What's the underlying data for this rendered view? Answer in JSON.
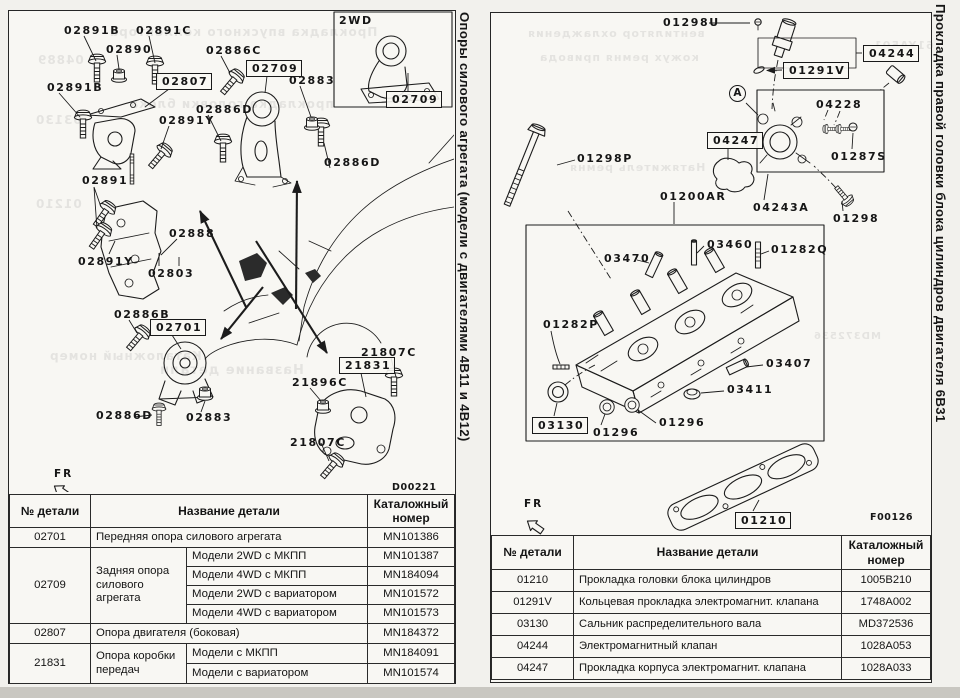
{
  "scan": {
    "paper_color": "#f8f7f3",
    "ink_color": "#1c1c1c",
    "margin_color": "#f2f1ed",
    "bottom_band_color": "#c9c7c1"
  },
  "left": {
    "title": "Опоры силового агрегата (модели с двигателями 4В11 и 4В12)",
    "labels": [
      {
        "t": "02891B",
        "x": 55,
        "y": 14
      },
      {
        "t": "02891C",
        "x": 127,
        "y": 14
      },
      {
        "t": "02890",
        "x": 97,
        "y": 33
      },
      {
        "t": "02886C",
        "x": 197,
        "y": 34
      },
      {
        "t": "02709",
        "x": 237,
        "y": 49,
        "b": 1
      },
      {
        "t": "02807",
        "x": 147,
        "y": 62,
        "b": 1
      },
      {
        "t": "02883",
        "x": 280,
        "y": 64
      },
      {
        "t": "02891B",
        "x": 38,
        "y": 71
      },
      {
        "t": "02886D",
        "x": 187,
        "y": 93
      },
      {
        "t": "02891Y",
        "x": 150,
        "y": 104
      },
      {
        "t": "02886D",
        "x": 315,
        "y": 146
      },
      {
        "t": "02891",
        "x": 73,
        "y": 164
      },
      {
        "t": "02888",
        "x": 160,
        "y": 217
      },
      {
        "t": "02891Y",
        "x": 69,
        "y": 245
      },
      {
        "t": "02803",
        "x": 139,
        "y": 257
      },
      {
        "t": "02886B",
        "x": 105,
        "y": 298
      },
      {
        "t": "02701",
        "x": 141,
        "y": 308,
        "b": 1
      },
      {
        "t": "02886D",
        "x": 87,
        "y": 399
      },
      {
        "t": "02883",
        "x": 177,
        "y": 401
      },
      {
        "t": "21807C",
        "x": 352,
        "y": 336
      },
      {
        "t": "21831",
        "x": 330,
        "y": 346,
        "b": 1
      },
      {
        "t": "21896C",
        "x": 283,
        "y": 366
      },
      {
        "t": "21807C",
        "x": 281,
        "y": 426
      },
      {
        "t": "2WD",
        "x": 330,
        "y": 4
      },
      {
        "t": "02709",
        "x": 377,
        "y": 80,
        "b": 1
      },
      {
        "t": "FR",
        "x": 45,
        "y": 458,
        "c": "fr"
      },
      {
        "t": "D00221",
        "x": 383,
        "y": 472,
        "c": "code"
      }
    ],
    "bleed": [
      {
        "t": "04889",
        "x": 28,
        "y": 42,
        "s": 12
      },
      {
        "t": "Прокладка впускного коллектора",
        "x": 100,
        "y": 14,
        "s": 12
      },
      {
        "t": "03130",
        "x": 26,
        "y": 102,
        "s": 12
      },
      {
        "t": "прокладка головки блока",
        "x": 120,
        "y": 86,
        "s": 12
      },
      {
        "t": "01210",
        "x": 26,
        "y": 186,
        "s": 12
      },
      {
        "t": "Каталожный номер",
        "x": 40,
        "y": 338,
        "s": 12
      },
      {
        "t": "Название детали",
        "x": 150,
        "y": 352,
        "s": 13
      }
    ],
    "table": {
      "h_num": "№ детали",
      "h_name": "Название детали",
      "h_code": "Каталожный номер",
      "rows": {
        "r1": {
          "num": "02701",
          "name": "Передняя опора силового агрегата",
          "code": "MN101386"
        },
        "r2": {
          "num": "02709",
          "name": "Задняя опора силового агрегата",
          "v1": "Модели 2WD с МКПП",
          "c1": "MN101387",
          "v2": "Модели 4WD с МКПП",
          "c2": "MN184094",
          "v3": "Модели 2WD с вариатором",
          "c3": "MN101572",
          "v4": "Модели 4WD с вариатором",
          "c4": "MN101573"
        },
        "r3": {
          "num": "02807",
          "name": "Опора двигателя (боковая)",
          "code": "MN184372"
        },
        "r4": {
          "num": "21831",
          "name": "Опора коробки передач",
          "v1": "Модели с МКПП",
          "c1": "MN184091",
          "v2": "Модели с вариатором",
          "c2": "MN101574"
        }
      }
    }
  },
  "right": {
    "title": "Прокладка правой головки блока цилиндров двигателя 6В31",
    "labels": [
      {
        "t": "01298U",
        "x": 172,
        "y": 4
      },
      {
        "t": "04244",
        "x": 372,
        "y": 32,
        "b": 1
      },
      {
        "t": "01291V",
        "x": 292,
        "y": 49,
        "b": 1
      },
      {
        "t": "A",
        "x": 238,
        "y": 72,
        "c": "circ"
      },
      {
        "t": "04228",
        "x": 325,
        "y": 86
      },
      {
        "t": "01287S",
        "x": 340,
        "y": 138
      },
      {
        "t": "04247",
        "x": 216,
        "y": 119,
        "b": 1
      },
      {
        "t": "01298P",
        "x": 86,
        "y": 140
      },
      {
        "t": "01200AR",
        "x": 169,
        "y": 178
      },
      {
        "t": "04243A",
        "x": 262,
        "y": 189
      },
      {
        "t": "01298",
        "x": 342,
        "y": 200
      },
      {
        "t": "03470",
        "x": 113,
        "y": 240
      },
      {
        "t": "03460",
        "x": 216,
        "y": 226
      },
      {
        "t": "01282Q",
        "x": 280,
        "y": 231
      },
      {
        "t": "01282P",
        "x": 52,
        "y": 306
      },
      {
        "t": "03407",
        "x": 275,
        "y": 345
      },
      {
        "t": "03411",
        "x": 236,
        "y": 371
      },
      {
        "t": "03130",
        "x": 41,
        "y": 404,
        "b": 1
      },
      {
        "t": "01296",
        "x": 102,
        "y": 414
      },
      {
        "t": "01296",
        "x": 168,
        "y": 404
      },
      {
        "t": "01210",
        "x": 244,
        "y": 499,
        "b": 1
      },
      {
        "t": "FR",
        "x": 33,
        "y": 486,
        "c": "fr"
      },
      {
        "t": "F00126",
        "x": 379,
        "y": 500,
        "c": "code"
      }
    ],
    "bleed": [
      {
        "t": "61YA501",
        "x": 382,
        "y": 26,
        "s": 11
      },
      {
        "t": "вентилятор охлаждения",
        "x": 36,
        "y": 14,
        "s": 11
      },
      {
        "t": "кожух ремня привода",
        "x": 48,
        "y": 38,
        "s": 11
      },
      {
        "t": "Натяжитель ремня",
        "x": 78,
        "y": 148,
        "s": 11
      },
      {
        "t": "MD372536",
        "x": 322,
        "y": 318,
        "s": 10
      }
    ],
    "table": {
      "h_num": "№ детали",
      "h_name": "Название детали",
      "h_code": "Каталожный номер",
      "rows": [
        {
          "num": "01210",
          "name": "Прокладка головки блока цилиндров",
          "code": "1005B210"
        },
        {
          "num": "01291V",
          "name": "Кольцевая прокладка электромагнит. клапана",
          "code": "1748A002"
        },
        {
          "num": "03130",
          "name": "Сальник распределительного вала",
          "code": "MD372536"
        },
        {
          "num": "04244",
          "name": "Электромагнитный клапан",
          "code": "1028A053"
        },
        {
          "num": "04247",
          "name": "Прокладка корпуса электромагнит. клапана",
          "code": "1028A033"
        }
      ]
    }
  }
}
